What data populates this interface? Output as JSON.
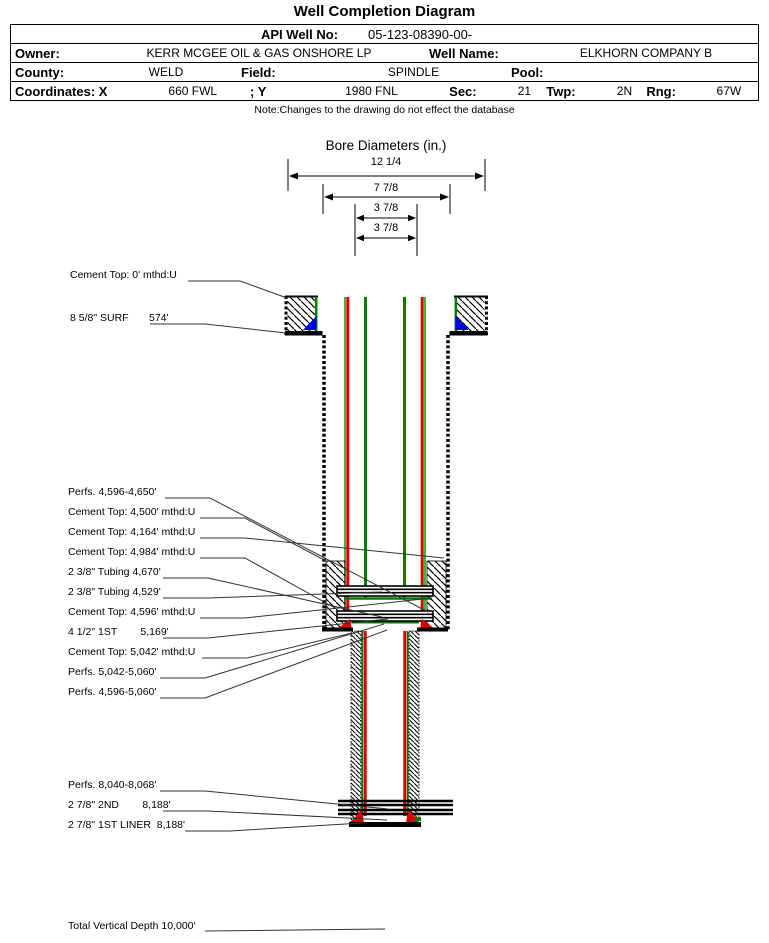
{
  "title": "Well Completion Diagram",
  "table": {
    "api_label": "API Well No:",
    "api_value": "05-123-08390-00-",
    "owner_label": "Owner:",
    "owner_value": "KERR MCGEE OIL & GAS ONSHORE LP",
    "well_name_label": "Well Name:",
    "well_name_value": "ELKHORN COMPANY B",
    "county_label": "County:",
    "county_value": "WELD",
    "field_label": "Field:",
    "field_value": "SPINDLE",
    "pool_label": "Pool:",
    "pool_value": "",
    "coords_label": "Coordinates: X",
    "coords_x_value": "660 FWL",
    "coords_y_label": "; Y",
    "coords_y_value": "1980 FNL",
    "sec_label": "Sec:",
    "sec_value": "21",
    "twp_label": "Twp:",
    "twp_value": "2N",
    "rng_label": "Rng:",
    "rng_value": "67W"
  },
  "note": "Note:Changes to the drawing do not effect the database",
  "bore": {
    "title": "Bore Diameters (in.)",
    "values": [
      "12 1/4",
      "7 7/8",
      "3 7/8",
      "3 7/8"
    ]
  },
  "annotations": [
    "Cement Top: 0' mthd:U",
    "8 5/8\" SURF       574'",
    "Perfs. 4,596-4,650'",
    "Cement Top: 4,500' mthd:U",
    "Cement Top: 4,164' mthd:U",
    "Cement Top: 4,984' mthd:U",
    "2 3/8\" Tubing 4,670'",
    "2 3/8\" Tubing 4,529'",
    "Cement Top: 4,596' mthd:U",
    "4 1/2\" 1ST        5,169'",
    "Cement Top: 5,042' mthd:U",
    "Perfs. 5,042-5,060'",
    "Perfs. 4,596-5,060'",
    "Perfs. 8,040-8,068'",
    "2 7/8\" 2ND        8,188'",
    "2 7/8\" 1ST LINER  8,188'"
  ],
  "footer": "Total Vertical Depth 10,000'",
  "colors": {
    "casing_green": "#008000",
    "tubing_red": "#dd0000",
    "shoe_blue": "#0000e0",
    "line_black": "#000000"
  }
}
